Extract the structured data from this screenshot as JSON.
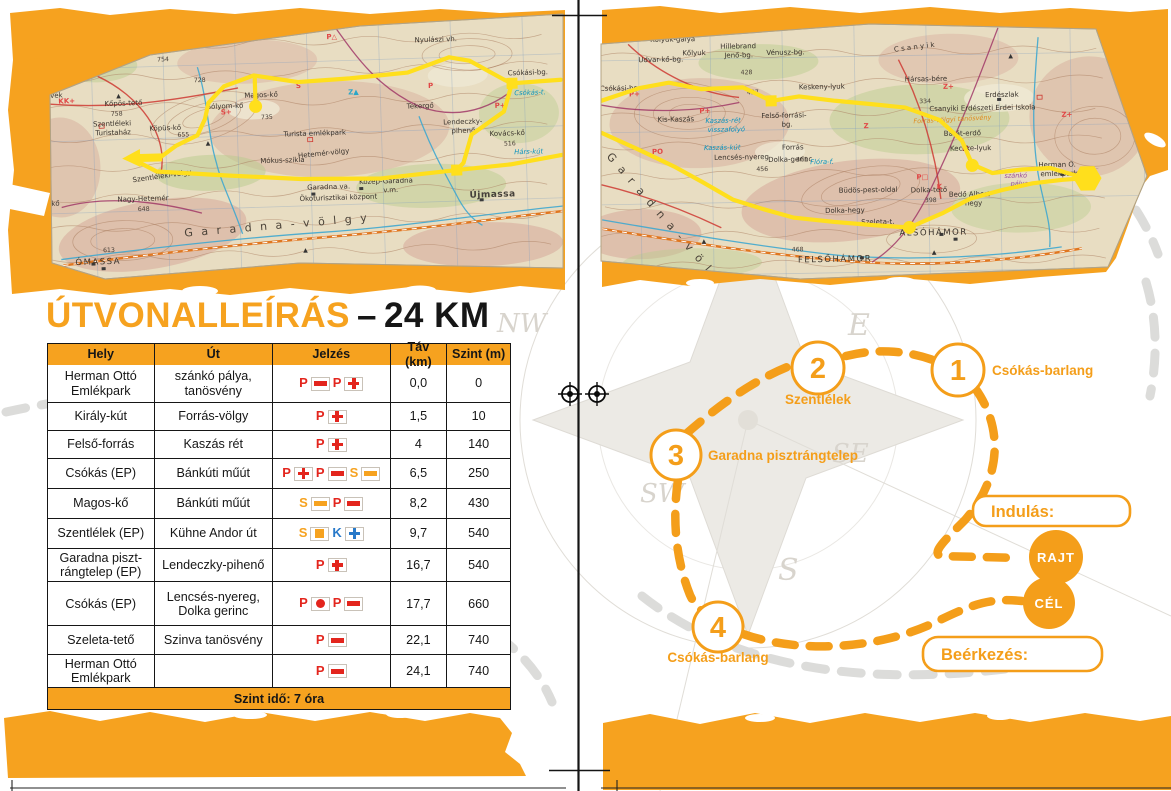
{
  "colors": {
    "orange": "#F6A21F",
    "red": "#E3251D",
    "blue": "#2879C9",
    "yellow": "#FFDF1C"
  },
  "compass": {
    "nw": "NW",
    "e": "E",
    "se": "SE",
    "sw": "SW",
    "s": "S"
  },
  "page_left": {
    "title": {
      "main": "ÚTVONALLEÍRÁS",
      "sep": "–",
      "distance": "24 KM"
    },
    "table": {
      "columns": [
        "Hely",
        "Út",
        "Jelzés",
        "Táv (km)",
        "Szint (m)"
      ],
      "rows": [
        {
          "hely": "Herman Ottó Emlékpark",
          "ut": "szánkó pálya, tanösvény",
          "jelzes": [
            {
              "letter": "P",
              "lc": "red",
              "sym": "bar",
              "sc": "red"
            },
            {
              "letter": "P",
              "lc": "red",
              "sym": "cross",
              "sc": "red"
            }
          ],
          "tav": "0,0",
          "szint": "0"
        },
        {
          "hely": "Király-kút",
          "ut": "Forrás-völgy",
          "jelzes": [
            {
              "letter": "P",
              "lc": "red",
              "sym": "cross",
              "sc": "red"
            }
          ],
          "tav": "1,5",
          "szint": "10"
        },
        {
          "hely": "Felső-forrás",
          "ut": "Kaszás rét",
          "jelzes": [
            {
              "letter": "P",
              "lc": "red",
              "sym": "cross",
              "sc": "red"
            }
          ],
          "tav": "4",
          "szint": "140"
        },
        {
          "hely": "Csókás (EP)",
          "ut": "Bánkúti műút",
          "jelzes": [
            {
              "letter": "P",
              "lc": "red",
              "sym": "cross",
              "sc": "red"
            },
            {
              "letter": "P",
              "lc": "red",
              "sym": "bar",
              "sc": "red"
            },
            {
              "letter": "S",
              "lc": "orange",
              "sym": "bar",
              "sc": "orange"
            }
          ],
          "tav": "6,5",
          "szint": "250"
        },
        {
          "hely": "Magos-kő",
          "ut": "Bánkúti műút",
          "jelzes": [
            {
              "letter": "S",
              "lc": "orange",
              "sym": "bar",
              "sc": "orange"
            },
            {
              "letter": "P",
              "lc": "red",
              "sym": "bar",
              "sc": "red"
            }
          ],
          "tav": "8,2",
          "szint": "430"
        },
        {
          "hely": "Szentlélek (EP)",
          "ut": "Kühne Andor út",
          "jelzes": [
            {
              "letter": "S",
              "lc": "orange",
              "sym": "square",
              "sc": "orange"
            },
            {
              "letter": "K",
              "lc": "blue",
              "sym": "cross",
              "sc": "blue"
            }
          ],
          "tav": "9,7",
          "szint": "540"
        },
        {
          "hely": "Garadna piszt-rángtelep (EP)",
          "ut": "Lendeczky-pihenő",
          "jelzes": [
            {
              "letter": "P",
              "lc": "red",
              "sym": "cross",
              "sc": "red"
            }
          ],
          "tav": "16,7",
          "szint": "540"
        },
        {
          "hely": "Csókás (EP)",
          "ut": "Lencsés-nyereg, Dolka gerinc",
          "jelzes": [
            {
              "letter": "P",
              "lc": "red",
              "sym": "dot",
              "sc": "red"
            },
            {
              "letter": "P",
              "lc": "red",
              "sym": "bar",
              "sc": "red"
            }
          ],
          "tav": "17,7",
          "szint": "660"
        },
        {
          "hely": "Szeleta-tető",
          "ut": "Szinva tanösvény",
          "jelzes": [
            {
              "letter": "P",
              "lc": "red",
              "sym": "bar",
              "sc": "red"
            }
          ],
          "tav": "22,1",
          "szint": "740"
        },
        {
          "hely": "Herman Ottó Emlékpark",
          "ut": "",
          "jelzes": [
            {
              "letter": "P",
              "lc": "red",
              "sym": "bar",
              "sc": "red"
            }
          ],
          "tav": "24,1",
          "szint": "740"
        }
      ],
      "footer": "Szint idő: 7 óra"
    }
  },
  "page_right": {
    "diagram": {
      "stops": [
        {
          "number": "1",
          "label": "Csókás-barlang"
        },
        {
          "number": "2",
          "label": "Szentlélek"
        },
        {
          "number": "3",
          "label": "Garadna pisztrángtelep"
        },
        {
          "number": "4",
          "label": "Csókás-barlang"
        }
      ],
      "start_box_label": "Indulás:",
      "finish_box_label": "Beérkezés:",
      "start_badge": "RAJT",
      "finish_badge": "CÉL"
    }
  },
  "maps": {
    "left": {
      "labels": [
        {
          "t": "Örvény-kő",
          "x": 148,
          "y": 47
        },
        {
          "t": "754",
          "x": 160,
          "y": 57,
          "c": "elev"
        },
        {
          "t": "728",
          "x": 196,
          "y": 79,
          "c": "elev"
        },
        {
          "t": "Magos-kő",
          "x": 246,
          "y": 96
        },
        {
          "t": "735",
          "x": 262,
          "y": 118,
          "c": "elev"
        },
        {
          "t": "Sólyom-kő",
          "x": 208,
          "y": 106
        },
        {
          "t": "Kőpös-tető",
          "x": 106,
          "y": 100
        },
        {
          "t": "758",
          "x": 112,
          "y": 110,
          "c": "elev"
        },
        {
          "t": "Szentléleki",
          "x": 94,
          "y": 120
        },
        {
          "t": "Turistaház",
          "x": 96,
          "y": 129
        },
        {
          "t": "Köpüs-kő",
          "x": 150,
          "y": 126
        },
        {
          "t": "655",
          "x": 178,
          "y": 133,
          "c": "elev"
        },
        {
          "t": "Látó-kövek",
          "x": 26,
          "y": 90
        },
        {
          "t": "Vörös-kő",
          "x": 28,
          "y": 198
        },
        {
          "t": "608",
          "x": 38,
          "y": 208,
          "c": "elev"
        },
        {
          "t": "Nagy-Hetemér",
          "x": 116,
          "y": 196
        },
        {
          "t": "648",
          "x": 136,
          "y": 206,
          "c": "elev"
        },
        {
          "t": "Szentléleki-völgy",
          "x": 132,
          "y": 177,
          "r": -6
        },
        {
          "t": "ÓMASSA",
          "x": 72,
          "y": 258,
          "c": "big"
        },
        {
          "t": "613",
          "x": 100,
          "y": 246,
          "c": "elev"
        },
        {
          "t": "G a r a d n a - v ö l g y",
          "x": 182,
          "y": 233,
          "c": "valley",
          "r": -3
        },
        {
          "t": "Mókus-szikla",
          "x": 260,
          "y": 162
        },
        {
          "t": "Garadna va.",
          "x": 306,
          "y": 190
        },
        {
          "t": "Ökoturisztikai központ",
          "x": 298,
          "y": 201
        },
        {
          "t": "Közép-Garadna",
          "x": 358,
          "y": 186
        },
        {
          "t": "v.m.",
          "x": 382,
          "y": 195
        },
        {
          "t": "Újmassa",
          "x": 468,
          "y": 203,
          "c": "big2"
        },
        {
          "t": "Tekergő",
          "x": 408,
          "y": 112
        },
        {
          "t": "Lendeczky-",
          "x": 444,
          "y": 129
        },
        {
          "t": "pihenő",
          "x": 452,
          "y": 138
        },
        {
          "t": "Kovács-kő",
          "x": 490,
          "y": 142
        },
        {
          "t": "516",
          "x": 504,
          "y": 152,
          "c": "elev"
        },
        {
          "t": "Hárs-kút",
          "x": 514,
          "y": 161,
          "c": "water"
        },
        {
          "t": "Csókási-bg.",
          "x": 510,
          "y": 82
        },
        {
          "t": "Csókás-t.",
          "x": 516,
          "y": 102,
          "c": "water"
        },
        {
          "t": "Nyulászi vh.",
          "x": 418,
          "y": 46
        },
        {
          "t": "Turista emlékpark",
          "x": 284,
          "y": 136
        },
        {
          "t": "Hetemér-völgy",
          "x": 298,
          "y": 158,
          "r": -4
        },
        {
          "t": "K+",
          "x": 58,
          "y": 44,
          "c": "mark"
        },
        {
          "t": "KK+",
          "x": 60,
          "y": 96,
          "c": "mark"
        },
        {
          "t": "P△",
          "x": 330,
          "y": 40,
          "c": "mark"
        },
        {
          "t": "S",
          "x": 298,
          "y": 88,
          "c": "mark"
        },
        {
          "t": "S+",
          "x": 222,
          "y": 112,
          "c": "mark"
        },
        {
          "t": "P+",
          "x": 496,
          "y": 114,
          "c": "mark"
        },
        {
          "t": "P",
          "x": 430,
          "y": 92,
          "c": "mark"
        },
        {
          "t": "Z▲",
          "x": 350,
          "y": 96,
          "c": "cmark"
        },
        {
          "t": "▲",
          "x": 118,
          "y": 92,
          "c": "peak"
        },
        {
          "t": "▲",
          "x": 300,
          "y": 252,
          "c": "peak"
        },
        {
          "t": "▲",
          "x": 206,
          "y": 142,
          "c": "peak"
        }
      ],
      "segments": [
        "160,153 176,142 198,132 206,116 210,100 226,84 256,74 300,82 352,80 410,76 452,62 472,66 506,86 514,90 563,88",
        "257,104 257,76",
        "514,90 505,118 472,140 463,168 456,175",
        "456,175 380,181 300,179 224,173 156,167 140,158",
        "456,175 510,171 563,163"
      ],
      "squares": [
        [
          514,
          90
        ],
        [
          456,
          175
        ]
      ],
      "dots": [
        [
          257,
          105
        ]
      ],
      "arrow": [
        140,
        153
      ]
    },
    "right": {
      "labels": [
        {
          "t": "Kőlyuk-galya",
          "x": 652,
          "y": 38
        },
        {
          "t": "Kőlyuk",
          "x": 684,
          "y": 52
        },
        {
          "t": "Hillebrand",
          "x": 722,
          "y": 46
        },
        {
          "t": "Jenő-bg.",
          "x": 726,
          "y": 55
        },
        {
          "t": "Vénusz-bg.",
          "x": 768,
          "y": 53
        },
        {
          "t": "Udvar-kő-bg.",
          "x": 640,
          "y": 58
        },
        {
          "t": "428",
          "x": 742,
          "y": 72,
          "c": "elev"
        },
        {
          "t": "427",
          "x": 748,
          "y": 92,
          "c": "elev"
        },
        {
          "t": "Keskeny-lyuk",
          "x": 800,
          "y": 88
        },
        {
          "t": "Kis-Kaszás",
          "x": 658,
          "y": 118
        },
        {
          "t": "Kaszás-rét",
          "x": 706,
          "y": 120,
          "c": "water"
        },
        {
          "t": "visszafolyó",
          "x": 708,
          "y": 129,
          "c": "water"
        },
        {
          "t": "Kaszás-kút",
          "x": 704,
          "y": 147,
          "c": "water"
        },
        {
          "t": "Felső-forrási-",
          "x": 762,
          "y": 116
        },
        {
          "t": "bg.",
          "x": 782,
          "y": 125
        },
        {
          "t": "Forrás",
          "x": 782,
          "y": 148
        },
        {
          "t": "Lencsés-nyereg",
          "x": 714,
          "y": 157
        },
        {
          "t": "Dolka-gerinc",
          "x": 768,
          "y": 160
        },
        {
          "t": "456",
          "x": 756,
          "y": 169,
          "c": "elev"
        },
        {
          "t": "Hársas-bére",
          "x": 906,
          "y": 82
        },
        {
          "t": "334",
          "x": 920,
          "y": 104,
          "c": "elev"
        },
        {
          "t": "C s a n y i k",
          "x": 896,
          "y": 52,
          "r": -6
        },
        {
          "t": "Erdészlak",
          "x": 986,
          "y": 99
        },
        {
          "t": "Csanyiki Erdészeti Erdei Iskola",
          "x": 930,
          "y": 112
        },
        {
          "t": "Forrás-völgyi tanösvény",
          "x": 914,
          "y": 124,
          "c": "omark",
          "r": -2
        },
        {
          "t": "Barát-erdő",
          "x": 944,
          "y": 137
        },
        {
          "t": "Kecske-lyuk",
          "x": 950,
          "y": 152
        },
        {
          "t": "Büdös-pest-oldal",
          "x": 838,
          "y": 192
        },
        {
          "t": "Dolka-hegy",
          "x": 824,
          "y": 212
        },
        {
          "t": "Dolka-tető",
          "x": 910,
          "y": 193
        },
        {
          "t": "398",
          "x": 924,
          "y": 203,
          "c": "elev"
        },
        {
          "t": "Bedő Albert-",
          "x": 948,
          "y": 198
        },
        {
          "t": "hegy",
          "x": 964,
          "y": 207
        },
        {
          "t": "ALSÓHÁMOR",
          "x": 898,
          "y": 236,
          "c": "big"
        },
        {
          "t": "FELSŐHÁMOR",
          "x": 796,
          "y": 261,
          "c": "big"
        },
        {
          "t": "Szeleta-t.",
          "x": 860,
          "y": 224
        },
        {
          "t": "Herman O.",
          "x": 1038,
          "y": 170
        },
        {
          "t": "emlékpark",
          "x": 1040,
          "y": 179
        },
        {
          "t": "szánkó",
          "x": 1004,
          "y": 180,
          "c": "purple"
        },
        {
          "t": "pálya",
          "x": 1010,
          "y": 188,
          "c": "purple"
        },
        {
          "t": "G a r a d n a - v ö l g y",
          "x": 606,
          "y": 152,
          "c": "valley",
          "r": 50
        },
        {
          "t": "Csókási-bg.",
          "x": 601,
          "y": 86
        },
        {
          "t": "461",
          "x": 796,
          "y": 160,
          "c": "elev"
        },
        {
          "t": "468",
          "x": 790,
          "y": 250,
          "c": "elev"
        },
        {
          "t": "Flóra-f.",
          "x": 810,
          "y": 163,
          "c": "water"
        },
        {
          "t": "P+",
          "x": 630,
          "y": 92,
          "c": "mark"
        },
        {
          "t": "P+",
          "x": 700,
          "y": 110,
          "c": "mark"
        },
        {
          "t": "Z+",
          "x": 944,
          "y": 90,
          "c": "mark"
        },
        {
          "t": "Z",
          "x": 864,
          "y": 128,
          "c": "mark"
        },
        {
          "t": "P□",
          "x": 916,
          "y": 180,
          "c": "mark"
        },
        {
          "t": "K",
          "x": 936,
          "y": 190,
          "c": "mark"
        },
        {
          "t": "Z+",
          "x": 1062,
          "y": 120,
          "c": "mark"
        },
        {
          "t": "PO",
          "x": 652,
          "y": 150,
          "c": "mark"
        },
        {
          "t": "▲",
          "x": 930,
          "y": 255,
          "c": "peak"
        },
        {
          "t": "▲",
          "x": 700,
          "y": 240,
          "c": "peak"
        },
        {
          "t": "▲",
          "x": 1010,
          "y": 60,
          "c": "peak"
        }
      ],
      "segments": [
        "602,96 640,84 670,79 702,86 744,85 772,99 800,95 836,100 872,104 906,108 940,121 962,142 972,166 992,175 1022,172 1050,171 1066,176 1085,182",
        "602,128 642,147 674,163 702,179 732,197 762,207 792,216 832,221 872,225 908,228 942,214 970,200 1002,192 1032,186 1062,183 1080,182"
      ],
      "squares": [
        [
          772,
          99
        ]
      ],
      "dots": [
        [
          908,
          228
        ],
        [
          972,
          167
        ]
      ],
      "hex": [
        1087,
        182
      ]
    }
  }
}
